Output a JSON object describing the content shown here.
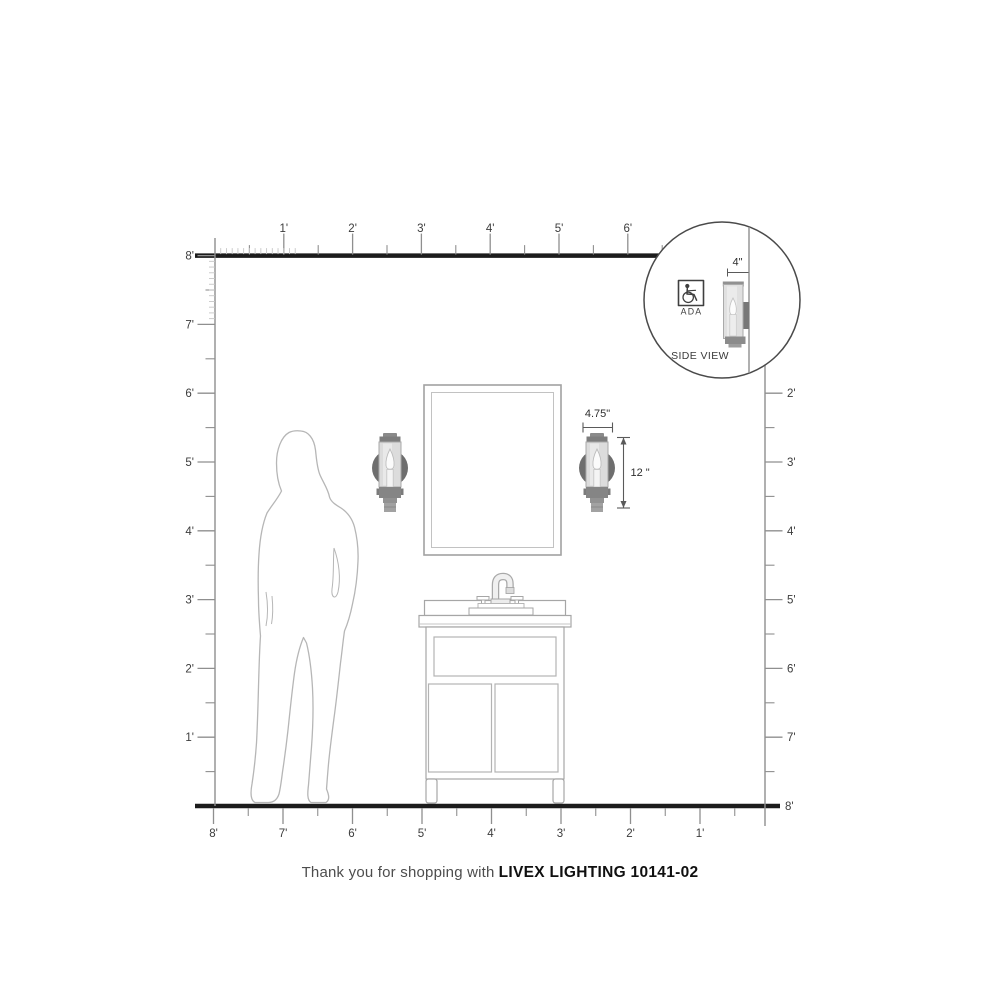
{
  "rulers": {
    "top": {
      "labels": [
        "1'",
        "2'",
        "3'",
        "4'",
        "5'",
        "6'"
      ]
    },
    "left": {
      "labels": [
        "8'",
        "7'",
        "6'",
        "5'",
        "4'",
        "3'",
        "2'",
        "1'"
      ]
    },
    "right": {
      "labels": [
        "2'",
        "3'",
        "4'",
        "5'",
        "6'",
        "7'",
        "8'"
      ]
    },
    "bottom": {
      "labels": [
        "8'",
        "7'",
        "6'",
        "5'",
        "4'",
        "3'",
        "2'",
        "1'"
      ]
    }
  },
  "dimensions": {
    "width_label": "4.75\"",
    "height_label": "12 \"",
    "depth_label": "4\""
  },
  "inset": {
    "side_view_label": "SIDE VIEW",
    "ada_label": "ADA"
  },
  "footer": {
    "prefix": "Thank you for shopping with",
    "product": "LIVEX LIGHTING 10141-02"
  },
  "colors": {
    "wall_line": "#1c1c1c",
    "ruler_line": "#8f8f8f",
    "fine_tick": "#c6c6c6",
    "label_text": "#3c3c3c",
    "fixture_backplate": "#6e6e6e",
    "fixture_shade": "#dcdcdc",
    "fixture_cap": "#7d7d7d",
    "outline_gray": "#a6a6a6",
    "silhouette_gray": "#b6b6b6"
  }
}
